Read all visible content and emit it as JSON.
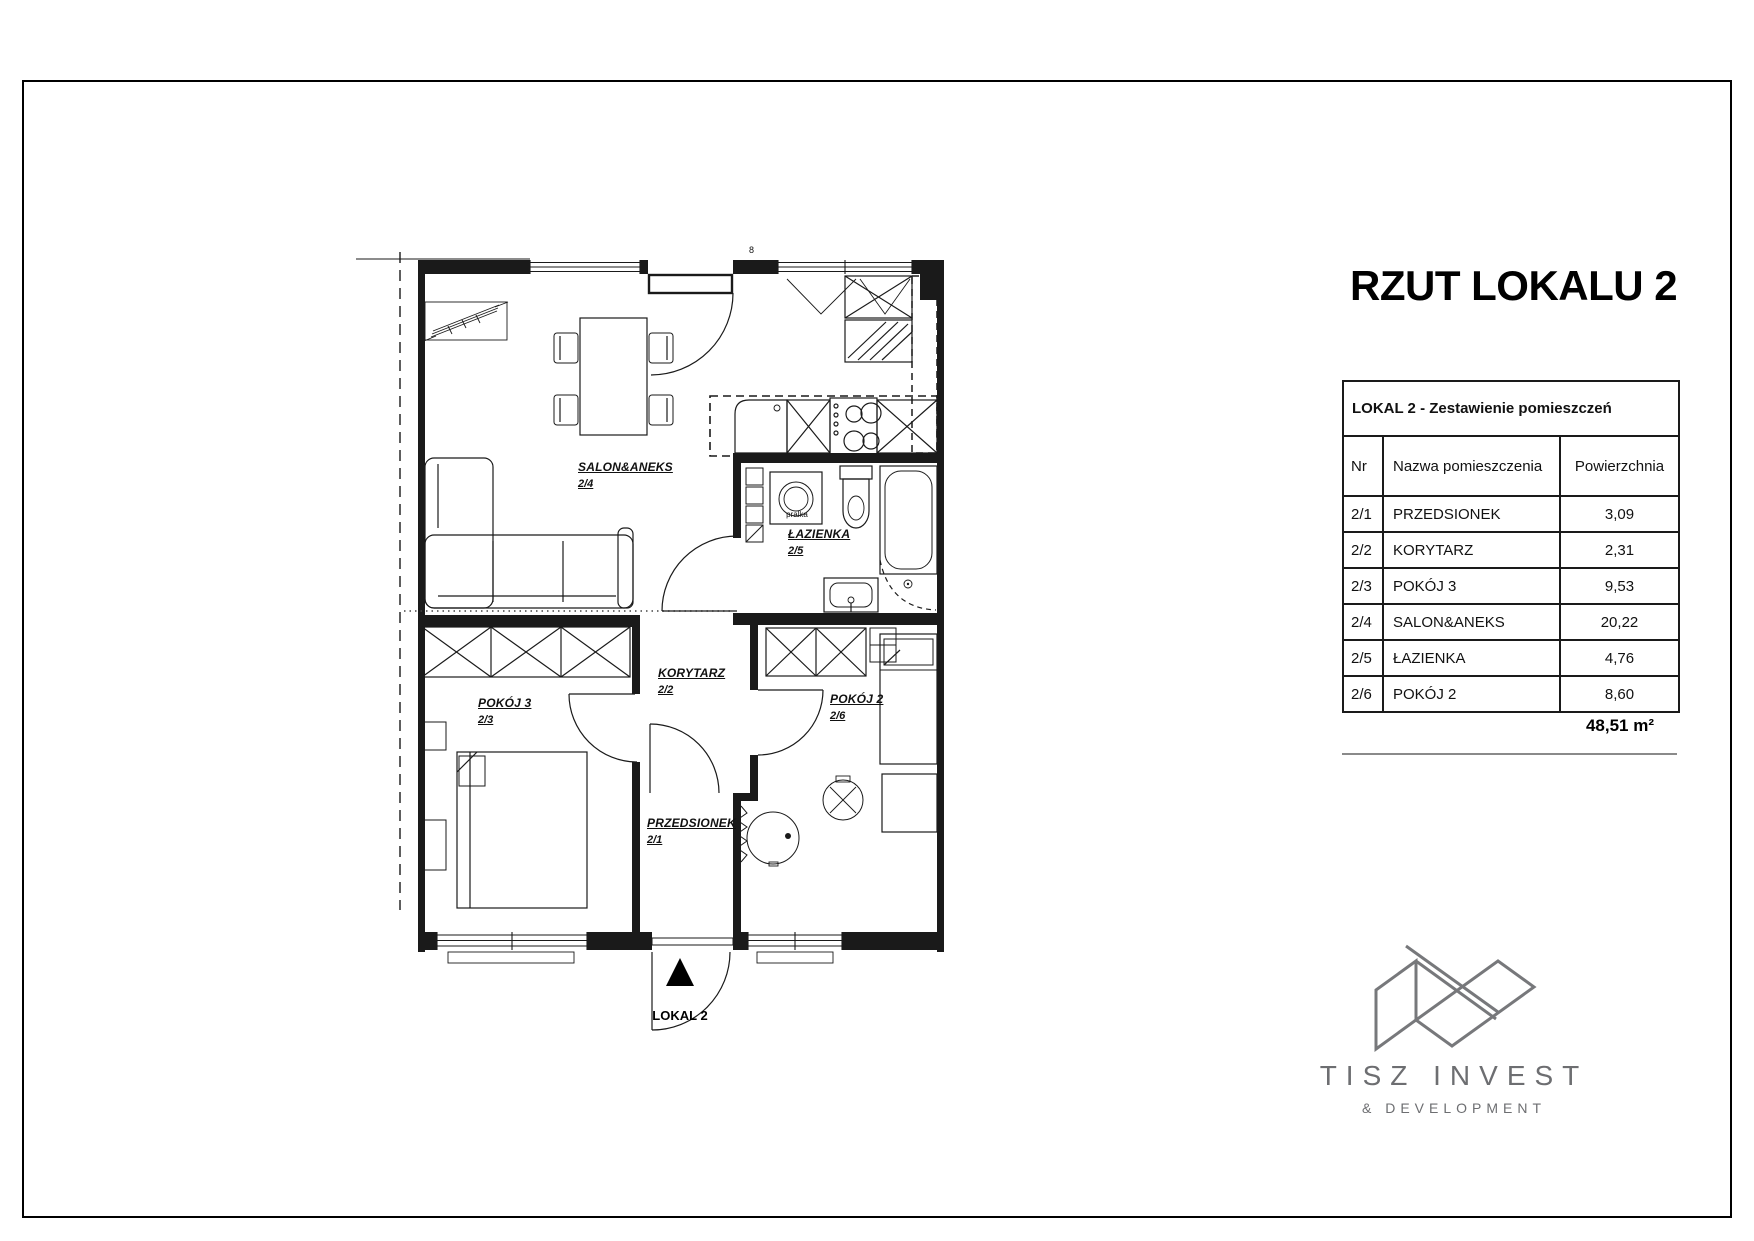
{
  "page_title": "RZUT LOKALU 2",
  "table": {
    "title": "LOKAL 2 - Zestawienie pomieszczeń",
    "col_nr": "Nr",
    "col_name": "Nazwa pomieszczenia",
    "col_area": "Powierzchnia",
    "rows": [
      {
        "nr": "2/1",
        "name": "PRZEDSIONEK",
        "area": "3,09"
      },
      {
        "nr": "2/2",
        "name": "KORYTARZ",
        "area": "2,31"
      },
      {
        "nr": "2/3",
        "name": "POKÓJ 3",
        "area": "9,53"
      },
      {
        "nr": "2/4",
        "name": "SALON&ANEKS",
        "area": "20,22"
      },
      {
        "nr": "2/5",
        "name": "ŁAZIENKA",
        "area": "4,76"
      },
      {
        "nr": "2/6",
        "name": "POKÓJ 2",
        "area": "8,60"
      }
    ],
    "total": "48,51 m²"
  },
  "plan": {
    "rooms": {
      "salon": {
        "label": "SALON&ANEKS",
        "nr": "2/4"
      },
      "lazienka": {
        "label": "ŁAZIENKA",
        "nr": "2/5"
      },
      "korytarz": {
        "label": "KORYTARZ",
        "nr": "2/2"
      },
      "pokoj3": {
        "label": "POKÓJ 3",
        "nr": "2/3"
      },
      "pokoj2": {
        "label": "POKÓJ 2",
        "nr": "2/6"
      },
      "przedsionek": {
        "label": "PRZEDSIONEK",
        "nr": "2/1"
      }
    },
    "washer_label": "pralka",
    "dim_label": "8",
    "entrance_label": "LOKAL 2"
  },
  "logo": {
    "name": "TISZ INVEST",
    "tagline": "& DEVELOPMENT",
    "color": "#6d6e71"
  }
}
